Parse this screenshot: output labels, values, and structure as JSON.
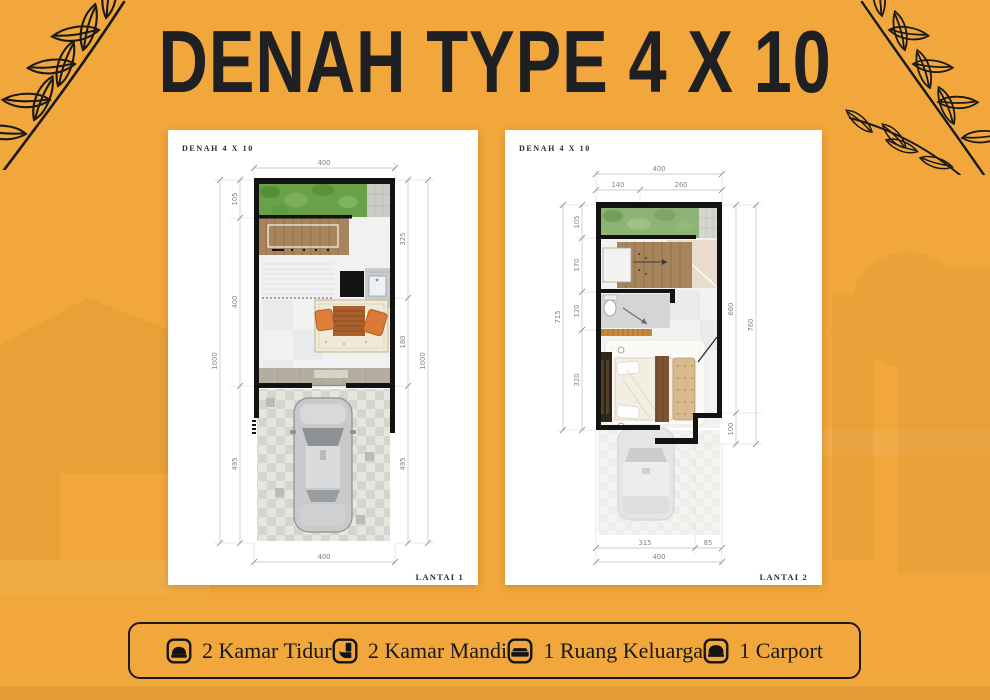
{
  "page": {
    "title": "DENAH TYPE 4 X 10"
  },
  "colors": {
    "background": "#F2A73C",
    "ink": "#1E2024",
    "card": "#FFFFFF",
    "wall": "#121212",
    "garden": "#69A148",
    "stairs": "#A8845C",
    "floor": "#F1F1F2",
    "rug": "#EFE9D8",
    "table": "#A85F2B",
    "chair": "#DF7F3A",
    "legend-border": "#1B1B1B"
  },
  "plans": [
    {
      "label": "DENAH 4 X 10",
      "floor_label": "LANTAI 1",
      "dims": {
        "top": "400",
        "bottom": "400",
        "left_overall": "1000",
        "left_segments": [
          "105",
          "400",
          "495"
        ],
        "right_overall": "1000",
        "right_segments": [
          "325",
          "180",
          "495"
        ]
      }
    },
    {
      "label": "DENAH 4 X 10",
      "floor_label": "LANTAI 2",
      "dims": {
        "top": "400",
        "top_segments": [
          "140",
          "260"
        ],
        "bottom": "400",
        "bottom_segments": [
          "315",
          "85"
        ],
        "left_overall": "715",
        "left_segments": [
          "105",
          "170",
          "120",
          "320"
        ],
        "right_inner": "660",
        "right_overall": "760",
        "right_step": "100"
      }
    }
  ],
  "legend": {
    "items": [
      {
        "icon": "bed-icon",
        "label": "2 Kamar Tidur"
      },
      {
        "icon": "toilet-icon",
        "label": "2 Kamar Mandi"
      },
      {
        "icon": "sofa-icon",
        "label": "1 Ruang Keluarga"
      },
      {
        "icon": "car-icon",
        "label": "1 Carport"
      }
    ]
  }
}
